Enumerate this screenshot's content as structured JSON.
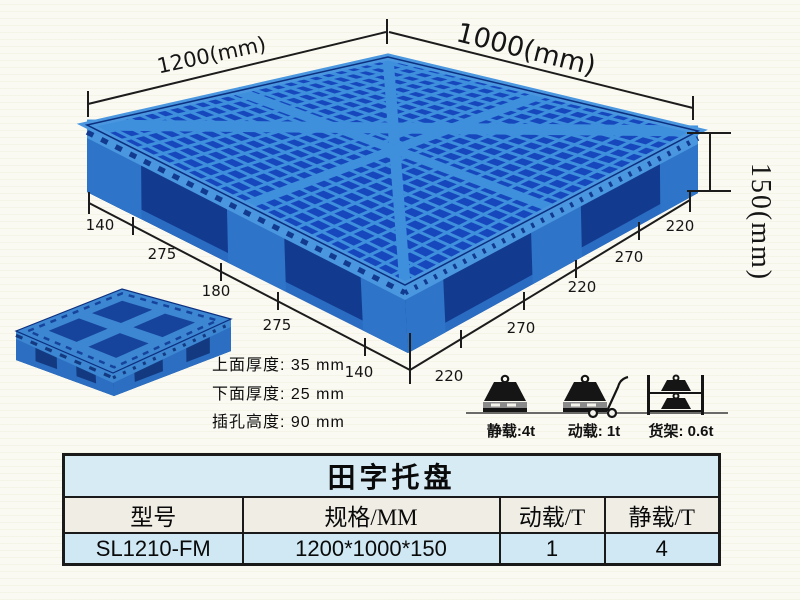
{
  "product": {
    "dims": {
      "length_label": "1200(mm)",
      "width_label": "1000(mm)",
      "height_label": "150(mm)",
      "left_edge_segments": [
        "140",
        "275",
        "180",
        "275",
        "140"
      ],
      "right_edge_segments": [
        "220",
        "270",
        "220",
        "270",
        "220"
      ]
    },
    "thickness_notes": [
      "上面厚度: 35 mm",
      "下面厚度: 25 mm",
      "插孔高度: 90 mm"
    ],
    "load_icons": [
      {
        "icon": "static-load-weight-icon",
        "label": "静载:4t"
      },
      {
        "icon": "dynamic-load-trolley-icon",
        "label": "动载: 1t"
      },
      {
        "icon": "rack-load-shelf-icon",
        "label": "货架: 0.6t"
      }
    ]
  },
  "spec_table": {
    "title": "田字托盘",
    "columns": [
      "型号",
      "规格/MM",
      "动载/T",
      "静载/T"
    ],
    "rows": [
      [
        "SL1210-FM",
        "1200*1000*150",
        "1",
        "4"
      ]
    ]
  },
  "colors": {
    "background": "#fbfaf2",
    "pallet_rib": "#3e8fdc",
    "pallet_hole": "#1747bd",
    "pallet_side": "#2e74c8",
    "pallet_side_dark": "#123a8f",
    "pallet_deck_edge": "#4a97e0",
    "pallet_skid": "#2a6cc2",
    "small_top": "#3c86d2",
    "small_hole": "#16439c",
    "small_side": "#2b6ec2",
    "small_side_dark": "#133a80",
    "line": "#1c1c1c",
    "table_border": "#1a1a1a",
    "title_bg": "#d6ebf4",
    "header_bg": "#f0ede5",
    "data_bg": "#cfe8f4"
  }
}
